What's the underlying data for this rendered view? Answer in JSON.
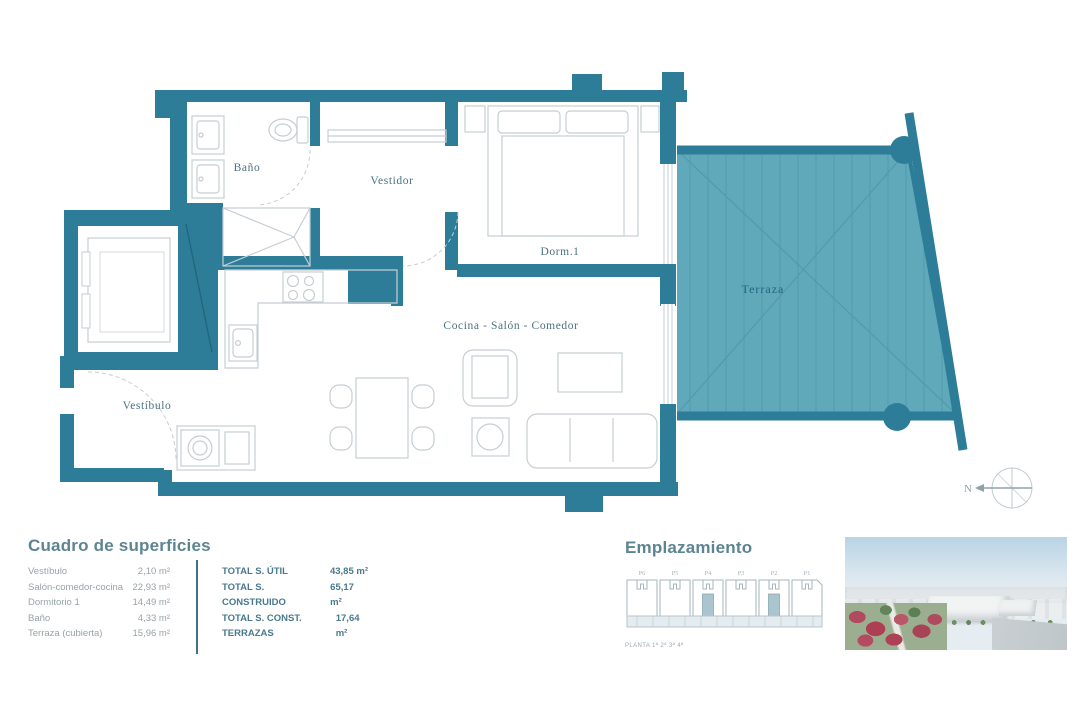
{
  "plan": {
    "labels": {
      "bano": "Baño",
      "vestidor": "Vestidor",
      "dorm1": "Dorm.1",
      "terraza": "Terraza",
      "cocina_salon": "Cocina - Salón - Comedor",
      "vestibulo": "Vestíbulo"
    },
    "north": "N"
  },
  "surfaces": {
    "title": "Cuadro de superficies",
    "rows": [
      {
        "label": "Vestíbulo",
        "value": "2,10 m²"
      },
      {
        "label": "Salón-comedor-cocina",
        "value": "22,93 m²"
      },
      {
        "label": "Dormitorio 1",
        "value": "14,49 m²"
      },
      {
        "label": "Baño",
        "value": "4,33 m²"
      },
      {
        "label": "Terraza (cubierta)",
        "value": "15,96 m²"
      }
    ],
    "totals": [
      {
        "label": "TOTAL S. ÚTIL",
        "value": "43,85 m²"
      },
      {
        "label": "TOTAL S. CONSTRUIDO",
        "value": "65,17 m²"
      },
      {
        "label": "TOTAL S. CONST. TERRAZAS",
        "value": "17,64 m²"
      }
    ]
  },
  "emplazamiento": {
    "title": "Emplazamiento",
    "blocks": [
      "P6",
      "P5",
      "P4",
      "P3",
      "P2",
      "P1"
    ],
    "caption": "PLANTA 1ª 2ª 3ª 4ª"
  },
  "colors": {
    "wall": "#2e7d98",
    "terrace": "#5fa9ba",
    "accent": "#3f7086"
  }
}
